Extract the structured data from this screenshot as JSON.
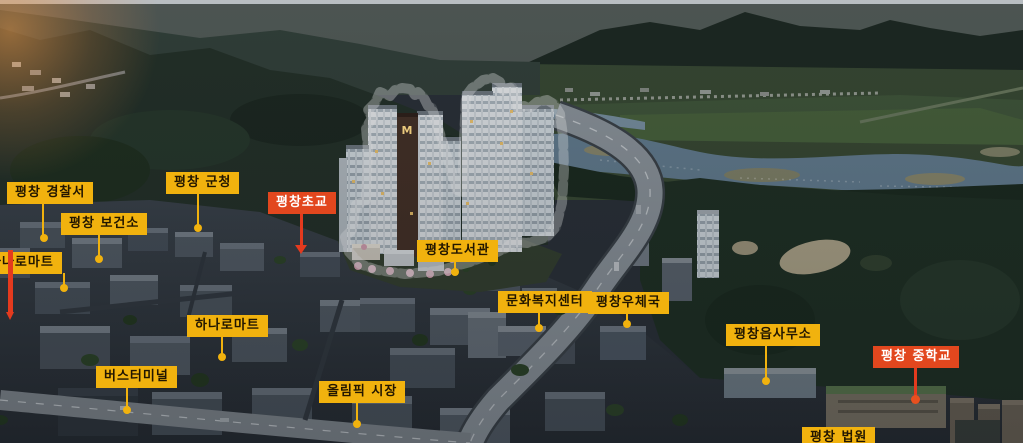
{
  "scene": {
    "description": "평창 아파트 단지 조감도",
    "colors": {
      "label_yellow": "#F1B20E",
      "label_text_dark": "#221600",
      "label_red": "#E2471E",
      "label_text_light": "#FFFFFF",
      "outline_red": "#E04B20",
      "outline_highlight": "#FF9E72",
      "marker_red": "#E43A1E"
    }
  },
  "complex": {
    "logo": "M"
  },
  "labels": [
    {
      "id": "pyeongchang-police-station",
      "text": "평창 경찰서",
      "style": "yellow"
    },
    {
      "id": "pyeongchang-county-office",
      "text": "평창 군청",
      "style": "yellow"
    },
    {
      "id": "pyeongchang-health-center",
      "text": "평창 보건소",
      "style": "yellow"
    },
    {
      "id": "hanaro-mart-left",
      "text": "하나로마트",
      "style": "yellow"
    },
    {
      "id": "pyeongchang-elementary-school",
      "text": "평창초교",
      "style": "red"
    },
    {
      "id": "pyeongchang-library",
      "text": "평창도서관",
      "style": "yellow"
    },
    {
      "id": "culture-welfare-center",
      "text": "문화복지센터",
      "style": "yellow"
    },
    {
      "id": "pyeongchang-post-office",
      "text": "평창우체국",
      "style": "yellow"
    },
    {
      "id": "hanaro-mart",
      "text": "하나로마트",
      "style": "yellow"
    },
    {
      "id": "bus-terminal",
      "text": "버스터미널",
      "style": "yellow"
    },
    {
      "id": "olympic-market",
      "text": "올림픽 시장",
      "style": "yellow"
    },
    {
      "id": "pyeongchang-eup-office",
      "text": "평창읍사무소",
      "style": "yellow"
    },
    {
      "id": "pyeongchang-middle-school",
      "text": "평창 중학교",
      "style": "red"
    },
    {
      "id": "pyeongchang-court",
      "text": "평창 법원",
      "style": "yellow"
    }
  ]
}
